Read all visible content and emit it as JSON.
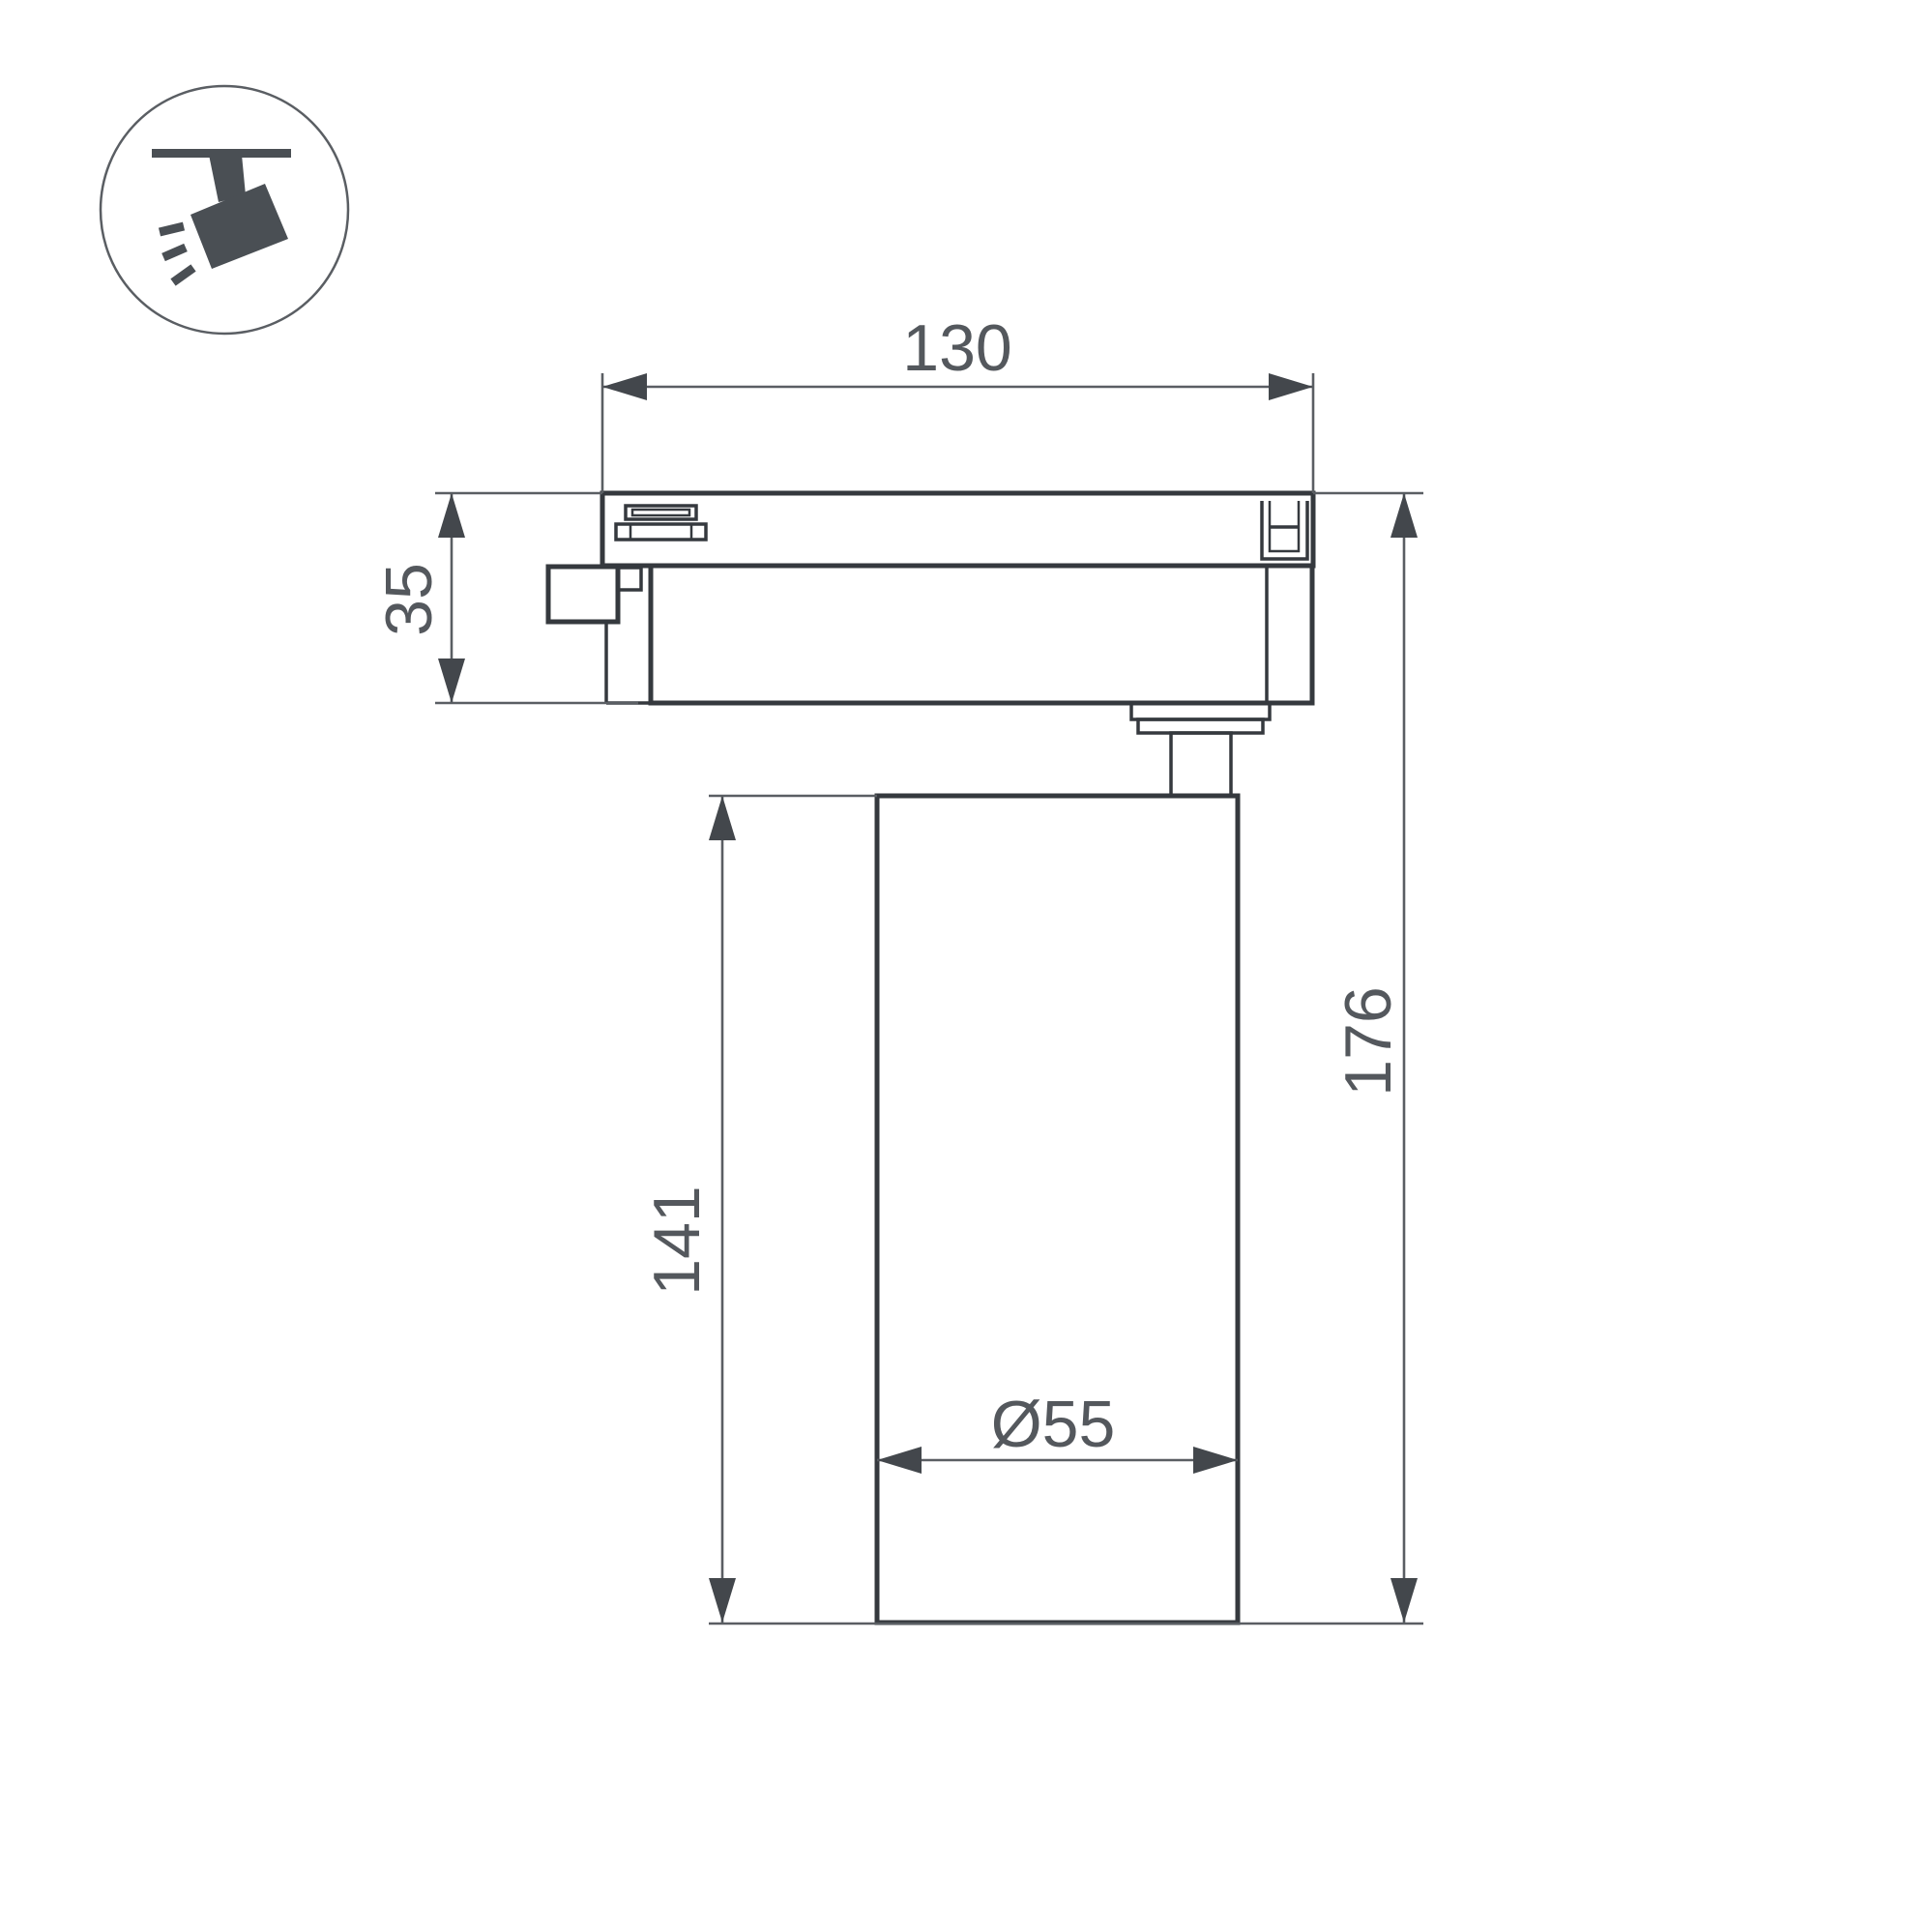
{
  "icon": {
    "name": "track-spotlight-pictogram"
  },
  "dimensions": {
    "track_width": "130",
    "adapter_height": "35",
    "lamp_height": "141",
    "total_height": "176",
    "lamp_diameter": "Ø55"
  },
  "colors": {
    "background": "#ffffff",
    "object_line": "#35393e",
    "dimension_line": "#5a5e63",
    "arrow_fill": "#43474c",
    "text": "#54585d",
    "icon_glyph": "#4a4f54",
    "icon_outline": "#5a5e63"
  }
}
